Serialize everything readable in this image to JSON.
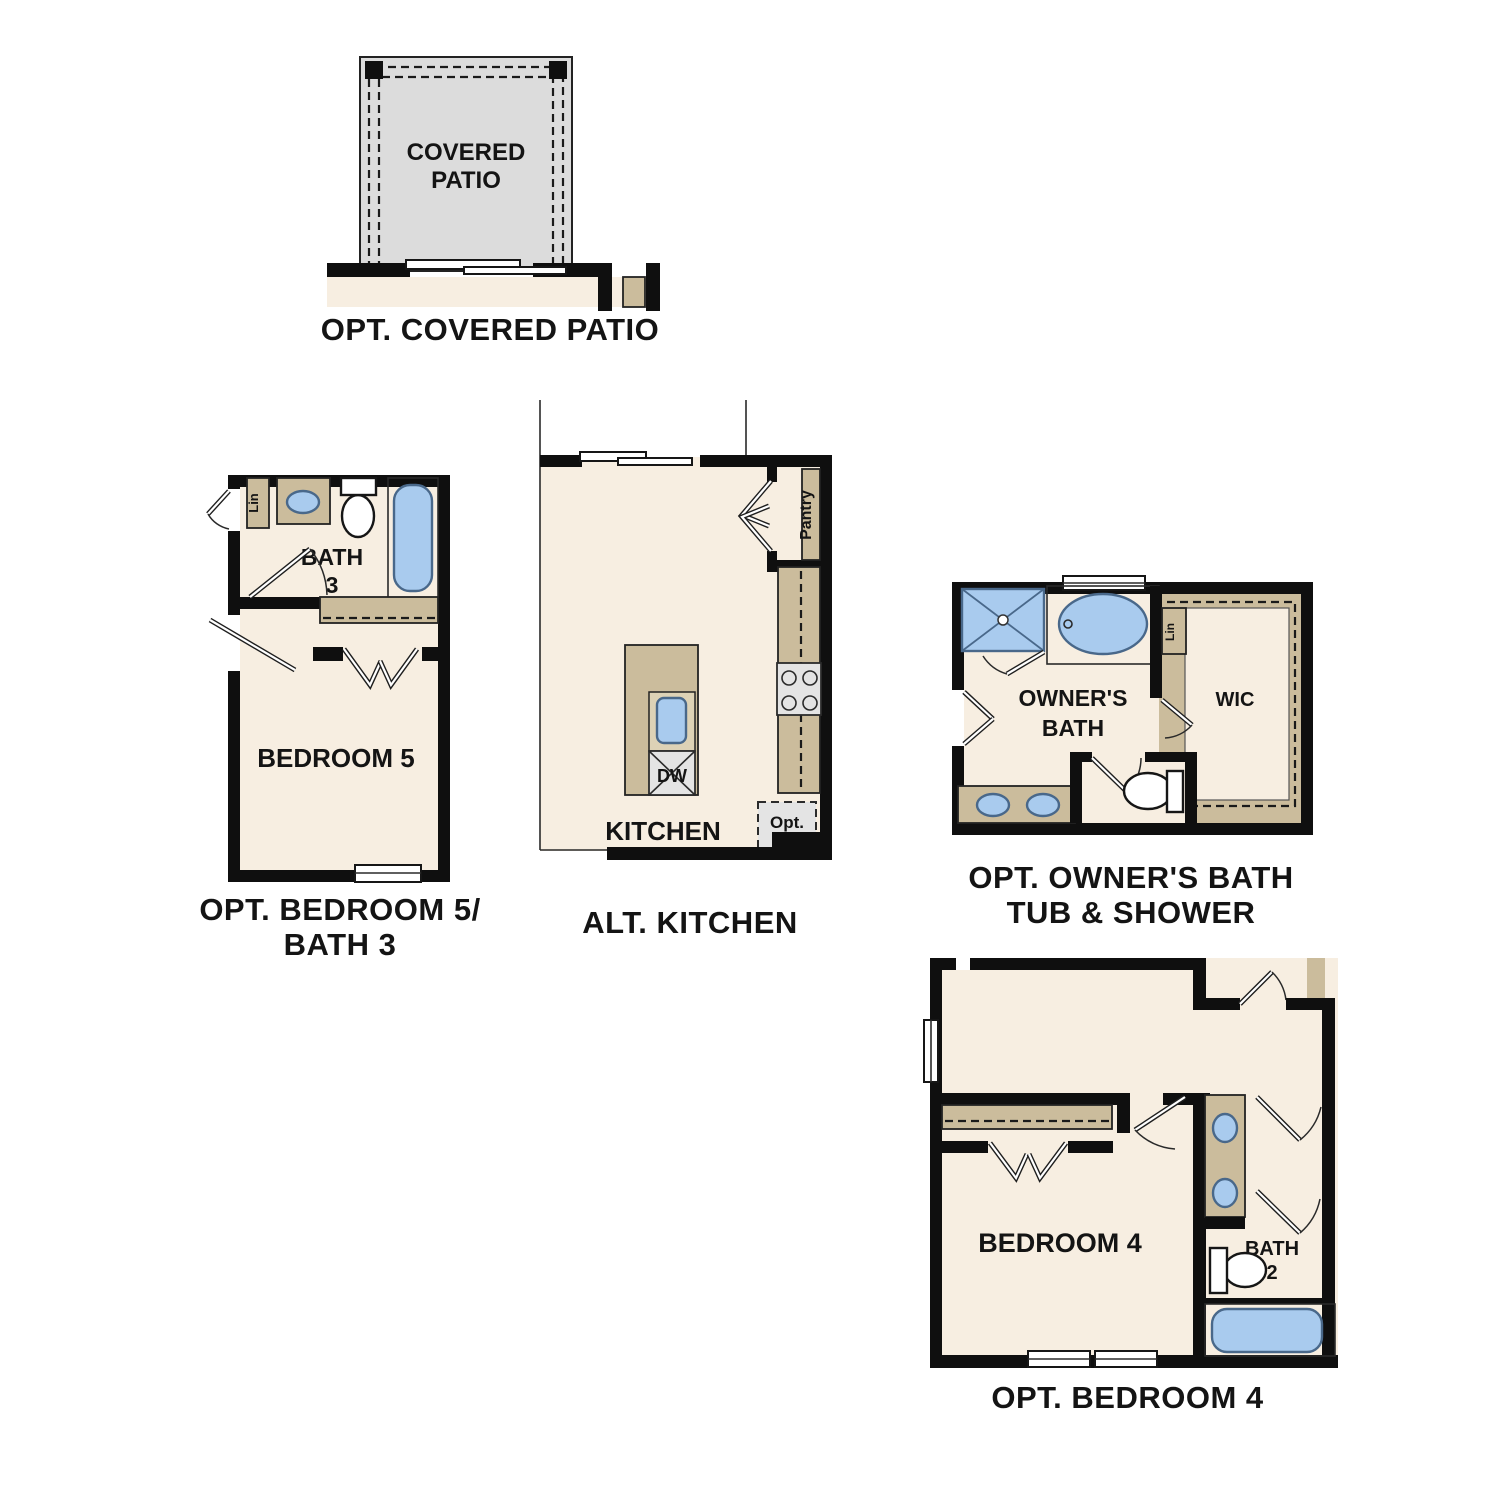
{
  "page_title": "Floor Plan Options",
  "colors": {
    "background": "#ffffff",
    "wall": "#0f0f0f",
    "floor": "#f7eee1",
    "counter": "#cbbc9c",
    "counter_light": "#ddd2b6",
    "patio": "#dcdcdc",
    "appliance": "#e4e4e4",
    "fixture_blue": "#a9cbee",
    "fixture_stroke": "#49688a",
    "text": "#141414"
  },
  "plans": {
    "covered_patio": {
      "caption": "OPT. COVERED PATIO",
      "room_lines": [
        "COVERED",
        "PATIO"
      ]
    },
    "bedroom5_bath3": {
      "caption_lines": [
        "OPT. BEDROOM 5/",
        "BATH 3"
      ],
      "bath_label_lines": [
        "BATH",
        "3"
      ],
      "bedroom_label": "BEDROOM 5",
      "linen_label": "Lin"
    },
    "alt_kitchen": {
      "caption": "ALT. KITCHEN",
      "kitchen_label": "KITCHEN",
      "pantry_label": "Pantry",
      "dishwasher_label": "DW",
      "opt_ref_lines": [
        "Opt.",
        "Ref"
      ]
    },
    "owners_bath": {
      "caption_lines": [
        "OPT. OWNER'S BATH",
        "TUB & SHOWER"
      ],
      "room_label_lines": [
        "OWNER'S",
        "BATH"
      ],
      "wic_label": "WIC",
      "linen_label": "Lin"
    },
    "bedroom4": {
      "caption": "OPT. BEDROOM 4",
      "bedroom_label": "BEDROOM 4",
      "bath_label_lines": [
        "BATH",
        "2"
      ]
    }
  }
}
